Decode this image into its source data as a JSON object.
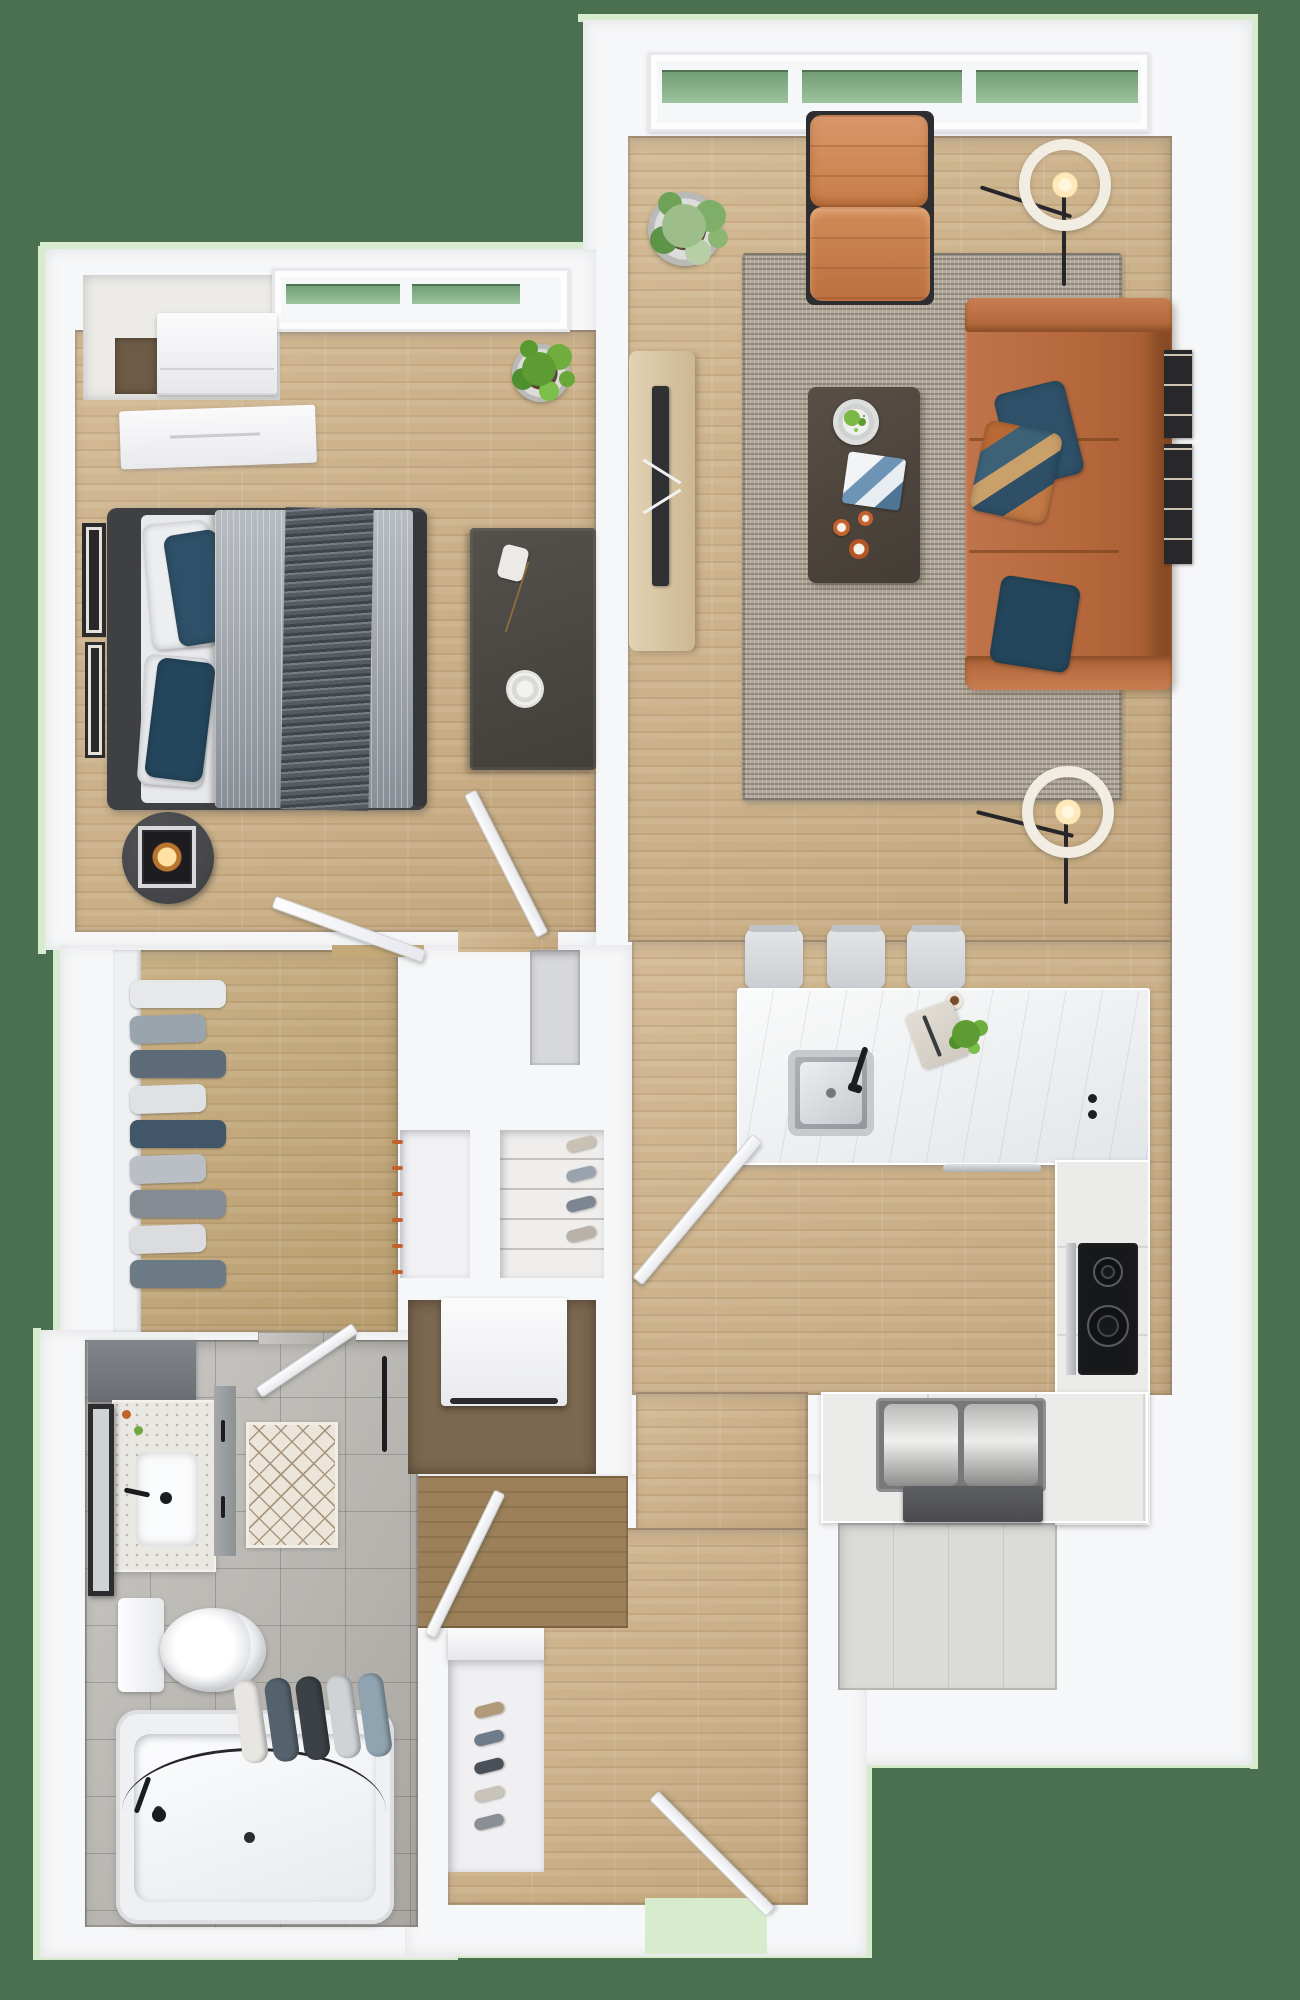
{
  "title": "3D top-down floor plan — one-bedroom apartment",
  "palette": {
    "bg": "#4a7050",
    "edge": "#d7eccd",
    "wall": "#f6f7f8",
    "wood": "#ceb288",
    "closetwood": "#c3a878",
    "vest": "#9b8059",
    "alcovegap": "#6e5b45",
    "tile": "#b9b6b1",
    "ktile": "#dbdbd7",
    "rug": "#b2a99a",
    "sofa": "#b5683c",
    "sofadark": "#8c4e2c",
    "chair": "#cd8352",
    "blue": "#2e5068",
    "navy": "#24465c",
    "dark": "#4a443e",
    "tv": "#303134",
    "oak": "#d9c6a4",
    "marble": "#eef0f1",
    "steel": "#c3c7cb",
    "cook": "#17181a",
    "glass": "#6f9a72",
    "lamp": "#f1ede3",
    "glow": "#ffe9b8",
    "frame": "#28282b",
    "accent": "#c4622e",
    "washerdark": "#2a2a2c",
    "toilet": "#f4f5f7"
  },
  "rooms": {
    "living_room": {
      "label": "Living Room",
      "furniture": [
        "leather sofa with blue pillows",
        "tufted accent chair",
        "coffee table with tray, plate and cups",
        "area rug",
        "tv console",
        "two ring floor lamps",
        "potted plant",
        "gallery wall frames",
        "triple window"
      ]
    },
    "bedroom": {
      "label": "Bedroom",
      "furniture": [
        "queen bed with gray duvet and blue pillows",
        "round nightstand with lantern lamp",
        "console desk",
        "built-in wardrobe",
        "dresser",
        "wall art frames",
        "potted plant",
        "window"
      ]
    },
    "walk_in_closet": {
      "label": "Walk-in Closet",
      "furniture": [
        "hanging clothes rail",
        "shelving"
      ]
    },
    "hall_closets": {
      "label": "Hall Closets",
      "furniture": [
        "cabinet with orange pulls",
        "shoe shelves",
        "stacked washer"
      ]
    },
    "kitchen": {
      "label": "Kitchen",
      "furniture": [
        "island with undermount sink and faucet",
        "three bar stools",
        "induction cooktop",
        "L-shaped counter",
        "serving trays",
        "herb plant"
      ]
    },
    "bathroom": {
      "label": "Bathroom",
      "furniture": [
        "vanity with sink and mirror",
        "toilet",
        "bathtub with rolled towels",
        "diamond bath mat",
        "towel bar"
      ]
    },
    "entry": {
      "label": "Entry Hall",
      "furniture": [
        "entry door ajar",
        "shoe niche",
        "interior doors"
      ]
    }
  },
  "gen": {
    "closet_clothes": [
      "#e6e8ea",
      "#9aa4ac",
      "#5d6b78",
      "#dfe2e4",
      "#42566a",
      "#b9bfc4",
      "#848b92",
      "#dadcdf",
      "#6c7a86"
    ],
    "tub_towels": [
      "#e8e6e2",
      "#55626e",
      "#3b4147",
      "#cfd3d6",
      "#8fa3b0"
    ],
    "entry_shoes": [
      "#b09a7a",
      "#6e7b88",
      "#4a5058",
      "#c9c4ba",
      "#8a8f96"
    ],
    "niche_shoes": [
      "#c9c2b4",
      "#9aa3ad",
      "#7d8690",
      "#b9b2a6"
    ],
    "orange_pulls": [
      "#c4622e",
      "#c4622e",
      "#c4622e",
      "#c4622e",
      "#c4622e",
      "#c4622e"
    ]
  },
  "counts": {
    "bar_stools": 3,
    "window_panes": 3,
    "sofa_cushions": 3
  }
}
